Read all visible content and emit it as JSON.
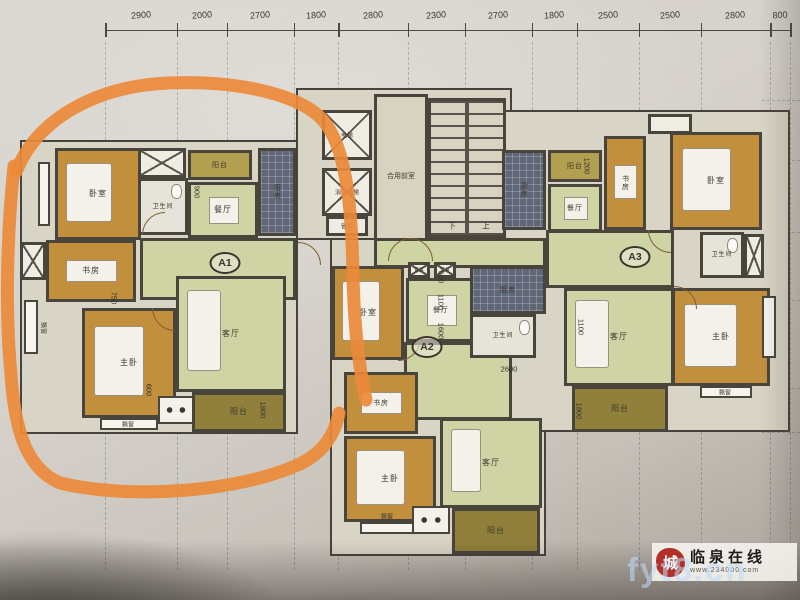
{
  "title": "residential floor plan photo",
  "marker": {
    "color": "#ec8a3a",
    "paths": [
      "M 16 172 C 38 116 100 86 168 83 C 242 80 306 96 326 124 C 348 154 352 218 353 274 C 354 332 360 372 366 400",
      "M 14 166 C 7 232 5 312 11 374 C 15 438 30 470 60 483 C 132 500 238 492 300 464 C 324 452 335 434 339 413"
    ]
  },
  "top_dimensions": [
    "2900",
    "2000",
    "2700",
    "1800",
    "2800",
    "2300",
    "2700",
    "1800",
    "2500",
    "2500",
    "2800",
    "800"
  ],
  "units": [
    {
      "label": "A1",
      "x": 225,
      "y": 263
    },
    {
      "label": "A2",
      "x": 427,
      "y": 347
    },
    {
      "label": "A3",
      "x": 635,
      "y": 257
    }
  ],
  "panels": [
    {
      "rect": [
        20,
        140,
        278,
        294
      ]
    },
    {
      "rect": [
        296,
        88,
        216,
        152
      ]
    },
    {
      "rect": [
        330,
        238,
        216,
        318
      ]
    },
    {
      "rect": [
        500,
        110,
        290,
        322
      ]
    }
  ],
  "rooms": [
    {
      "name": "a1-bedroom",
      "label": "卧室",
      "type": "bedroom",
      "rect": [
        55,
        148,
        86,
        92
      ],
      "furn": "bed"
    },
    {
      "name": "a1-shaft",
      "label": "",
      "type": "shaft",
      "rect": [
        138,
        148,
        48,
        30
      ]
    },
    {
      "name": "a1-bath",
      "label": "卫生间",
      "type": "bath",
      "rect": [
        138,
        178,
        50,
        57
      ],
      "fs": 6
    },
    {
      "name": "a1-balcony-top",
      "label": "阳台",
      "type": "balcony",
      "rect": [
        188,
        150,
        64,
        30
      ],
      "fs": 7
    },
    {
      "name": "a1-dining",
      "label": "餐厅",
      "type": "green",
      "rect": [
        188,
        182,
        70,
        56
      ],
      "furn": "table"
    },
    {
      "name": "a1-kitchen",
      "label": "厨房",
      "type": "kitchen",
      "rect": [
        258,
        148,
        38,
        88
      ],
      "fs": 7,
      "vert": true
    },
    {
      "name": "a1-hall",
      "label": "",
      "type": "green",
      "rect": [
        140,
        238,
        156,
        62
      ]
    },
    {
      "name": "a1-study",
      "label": "书房",
      "type": "bedroom",
      "rect": [
        46,
        240,
        90,
        62
      ],
      "furn": "desk"
    },
    {
      "name": "a1-shaft-left",
      "label": "",
      "type": "shaft",
      "rect": [
        20,
        242,
        26,
        38
      ]
    },
    {
      "name": "a1-master",
      "label": "主卧",
      "type": "bedroom",
      "rect": [
        82,
        308,
        94,
        110
      ],
      "furn": "bed"
    },
    {
      "name": "a1-living",
      "label": "客厅",
      "type": "green",
      "rect": [
        176,
        276,
        110,
        116
      ],
      "furn": "sofa"
    },
    {
      "name": "a1-balcony-bottom",
      "label": "阳台",
      "type": "balcony-dark",
      "rect": [
        192,
        392,
        94,
        40
      ]
    },
    {
      "name": "a1-acbox",
      "label": "",
      "type": "acbox",
      "rect": [
        158,
        396,
        36,
        28
      ]
    },
    {
      "name": "a1-bay-1",
      "label": "",
      "type": "bay",
      "rect": [
        38,
        162,
        12,
        64
      ]
    },
    {
      "name": "a1-bay-2",
      "label": "",
      "type": "bay",
      "rect": [
        24,
        300,
        14,
        54
      ]
    },
    {
      "name": "a1-bay-3",
      "label": "",
      "type": "bay",
      "rect": [
        100,
        418,
        58,
        12
      ]
    },
    {
      "name": "core-elevator-1",
      "label": "",
      "type": "shaft",
      "rect": [
        322,
        110,
        50,
        50
      ]
    },
    {
      "name": "core-elevator-2",
      "label": "",
      "type": "shaft",
      "rect": [
        322,
        168,
        50,
        48
      ]
    },
    {
      "name": "core-pipe",
      "label": "",
      "type": "white",
      "rect": [
        326,
        216,
        42,
        20
      ]
    },
    {
      "name": "core-front-room",
      "label": "",
      "type": "beige",
      "rect": [
        374,
        94,
        54,
        148
      ]
    },
    {
      "name": "core-stair",
      "label": "",
      "type": "stair",
      "rect": [
        428,
        98,
        78,
        140
      ]
    },
    {
      "name": "core-corridor",
      "label": "",
      "type": "green",
      "rect": [
        374,
        238,
        172,
        30
      ]
    },
    {
      "name": "a2-bedroom",
      "label": "卧室",
      "type": "bedroom",
      "rect": [
        332,
        266,
        72,
        94
      ],
      "furn": "bed"
    },
    {
      "name": "a2-shaft-1",
      "label": "",
      "type": "shaft",
      "rect": [
        408,
        262,
        22,
        16
      ]
    },
    {
      "name": "a2-shaft-2",
      "label": "",
      "type": "shaft",
      "rect": [
        434,
        262,
        22,
        16
      ]
    },
    {
      "name": "a2-dining",
      "label": "餐厅",
      "type": "green",
      "rect": [
        406,
        278,
        70,
        64
      ],
      "furn": "table",
      "fs": 7
    },
    {
      "name": "a2-hall",
      "label": "",
      "type": "green",
      "rect": [
        404,
        342,
        108,
        78
      ]
    },
    {
      "name": "a2-kitchen",
      "label": "厨房",
      "type": "kitchen",
      "rect": [
        470,
        266,
        76,
        48
      ],
      "fs": 7
    },
    {
      "name": "a2-bath",
      "label": "卫生间",
      "type": "bath",
      "rect": [
        470,
        314,
        66,
        44
      ],
      "fs": 6
    },
    {
      "name": "a2-study",
      "label": "书房",
      "type": "bedroom",
      "rect": [
        344,
        372,
        74,
        62
      ],
      "furn": "desk",
      "fs": 7
    },
    {
      "name": "a2-master",
      "label": "主卧",
      "type": "bedroom",
      "rect": [
        344,
        436,
        92,
        86
      ],
      "furn": "bed"
    },
    {
      "name": "a2-living",
      "label": "客厅",
      "type": "green",
      "rect": [
        440,
        418,
        102,
        90
      ],
      "furn": "sofa"
    },
    {
      "name": "a2-balcony",
      "label": "阳台",
      "type": "balcony-dark",
      "rect": [
        452,
        508,
        88,
        46
      ]
    },
    {
      "name": "a2-acbox",
      "label": "",
      "type": "acbox",
      "rect": [
        412,
        506,
        38,
        28
      ]
    },
    {
      "name": "a2-bay",
      "label": "",
      "type": "bay",
      "rect": [
        360,
        522,
        54,
        12
      ]
    },
    {
      "name": "a3-kitchen",
      "label": "厨房",
      "type": "kitchen",
      "rect": [
        502,
        150,
        44,
        80
      ],
      "fs": 7,
      "vert": true
    },
    {
      "name": "a3-balcony-top",
      "label": "阳台",
      "type": "balcony",
      "rect": [
        548,
        150,
        54,
        32
      ],
      "fs": 7
    },
    {
      "name": "a3-dining",
      "label": "餐厅",
      "type": "green",
      "rect": [
        548,
        184,
        54,
        48
      ],
      "furn": "table",
      "fs": 7
    },
    {
      "name": "a3-study",
      "label": "书房",
      "type": "bedroom",
      "rect": [
        604,
        136,
        42,
        94
      ],
      "furn": "desk",
      "fs": 7,
      "vert": true
    },
    {
      "name": "a3-shaft-top",
      "label": "",
      "type": "white",
      "rect": [
        648,
        114,
        44,
        20
      ]
    },
    {
      "name": "a3-bedroom",
      "label": "卧室",
      "type": "bedroom",
      "rect": [
        670,
        132,
        92,
        98
      ],
      "furn": "bed"
    },
    {
      "name": "a3-hall",
      "label": "",
      "type": "green",
      "rect": [
        546,
        230,
        128,
        58
      ]
    },
    {
      "name": "a3-bath",
      "label": "卫生间",
      "type": "bath",
      "rect": [
        700,
        232,
        44,
        46
      ],
      "fs": 6
    },
    {
      "name": "a3-shaft",
      "label": "",
      "type": "shaft",
      "rect": [
        744,
        234,
        20,
        44
      ]
    },
    {
      "name": "a3-living",
      "label": "客厅",
      "type": "green",
      "rect": [
        564,
        288,
        110,
        98
      ],
      "furn": "sofa"
    },
    {
      "name": "a3-master",
      "label": "主卧",
      "type": "bedroom",
      "rect": [
        672,
        288,
        98,
        98
      ],
      "furn": "bed"
    },
    {
      "name": "a3-balcony-bottom",
      "label": "阳台",
      "type": "balcony-dark",
      "rect": [
        572,
        386,
        96,
        46
      ]
    },
    {
      "name": "a3-bay-1",
      "label": "",
      "type": "bay",
      "rect": [
        700,
        386,
        52,
        12
      ]
    },
    {
      "name": "a3-bay-2",
      "label": "",
      "type": "bay",
      "rect": [
        762,
        296,
        14,
        62
      ]
    }
  ],
  "labels": [
    {
      "t": "合用前室",
      "x": 401,
      "y": 176,
      "s": 7
    },
    {
      "t": "电梯",
      "x": 347,
      "y": 135,
      "s": 6
    },
    {
      "t": "消防电梯",
      "x": 347,
      "y": 192,
      "s": 6
    },
    {
      "t": "管井",
      "x": 347,
      "y": 226,
      "s": 6
    },
    {
      "t": "下",
      "x": 452,
      "y": 226,
      "s": 8
    },
    {
      "t": "上",
      "x": 486,
      "y": 226,
      "s": 8
    },
    {
      "t": "管井",
      "x": 419,
      "y": 270,
      "s": 5
    },
    {
      "t": "管井",
      "x": 445,
      "y": 270,
      "s": 5
    },
    {
      "t": "飘窗",
      "x": 44,
      "y": 328,
      "s": 6,
      "r": 90
    },
    {
      "t": "飘窗",
      "x": 128,
      "y": 424,
      "s": 6
    },
    {
      "t": "飘窗",
      "x": 387,
      "y": 516,
      "s": 6
    },
    {
      "t": "飘窗",
      "x": 725,
      "y": 392,
      "s": 6
    }
  ],
  "dim_labels": [
    {
      "t": "900",
      "x": 197,
      "y": 192,
      "r": 90
    },
    {
      "t": "750",
      "x": 114,
      "y": 298,
      "r": 90
    },
    {
      "t": "600",
      "x": 149,
      "y": 390,
      "r": 90
    },
    {
      "t": "1800",
      "x": 263,
      "y": 410,
      "r": 90
    },
    {
      "t": "600",
      "x": 441,
      "y": 277,
      "r": 90
    },
    {
      "t": "1100",
      "x": 441,
      "y": 302,
      "r": 90
    },
    {
      "t": "1600",
      "x": 441,
      "y": 331,
      "r": 90
    },
    {
      "t": "2600",
      "x": 509,
      "y": 369,
      "r": 0
    },
    {
      "t": "1200",
      "x": 587,
      "y": 166,
      "r": 90
    },
    {
      "t": "1100",
      "x": 581,
      "y": 327,
      "r": 90
    },
    {
      "t": "1800",
      "x": 579,
      "y": 411,
      "r": 90
    }
  ],
  "doors": [
    {
      "x": 298,
      "y": 242,
      "r": 90
    },
    {
      "x": 142,
      "y": 212,
      "r": 0
    },
    {
      "x": 152,
      "y": 308,
      "r": 270
    },
    {
      "x": 398,
      "y": 338,
      "r": 180
    },
    {
      "x": 388,
      "y": 238,
      "r": 0
    },
    {
      "x": 410,
      "y": 238,
      "r": 90
    },
    {
      "x": 648,
      "y": 230,
      "r": 270
    },
    {
      "x": 674,
      "y": 286,
      "r": 90
    }
  ],
  "grid": {
    "x_start": 105,
    "x_end": 790,
    "h_lines": [
      100,
      160,
      232,
      300,
      388,
      432
    ],
    "h_from": 762,
    "h_to": 800
  },
  "watermark": {
    "seal_char": "城",
    "site_name": "临泉在线",
    "site_url": "www.234000.com",
    "overlay_text": "fyt8.cn"
  }
}
